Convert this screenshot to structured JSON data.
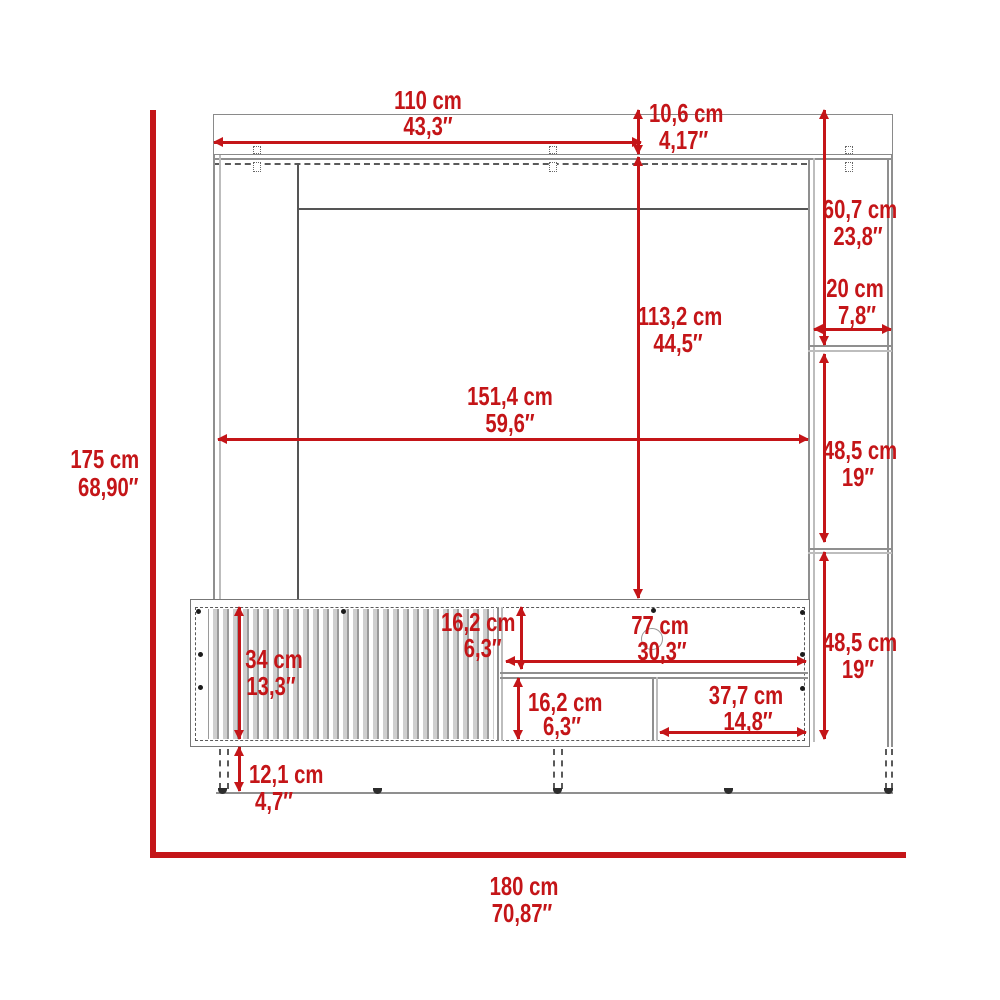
{
  "diagram_type": "furniture-dimension-drawing",
  "units": [
    "cm",
    "inches"
  ],
  "colors": {
    "dimension_red": "#c41518",
    "outline_gray": "#8a8a8a",
    "detail_dark_gray": "#555555",
    "background": "#ffffff"
  },
  "dims": {
    "overall_height": {
      "cm": "175 cm",
      "in": "68,90″"
    },
    "overall_width": {
      "cm": "180 cm",
      "in": "70,87″"
    },
    "top_width": {
      "cm": "110 cm",
      "in": "43,3″"
    },
    "top_panel_height": {
      "cm": "10,6 cm",
      "in": "4,17″"
    },
    "right_upper_height": {
      "cm": "60,7 cm",
      "in": "23,8″"
    },
    "side_depth": {
      "cm": "20 cm",
      "in": "7,8″"
    },
    "back_panel_height": {
      "cm": "113,2 cm",
      "in": "44,5″"
    },
    "interior_width": {
      "cm": "151,4 cm",
      "in": "59,6″"
    },
    "right_shelf_upper": {
      "cm": "48,5 cm",
      "in": "19″"
    },
    "right_shelf_lower": {
      "cm": "48,5 cm",
      "in": "19″"
    },
    "door_height": {
      "cm": "34 cm",
      "in": "13,3″"
    },
    "leg_clearance": {
      "cm": "12,1 cm",
      "in": "4,7″"
    },
    "upper_opening_height": {
      "cm": "16,2 cm",
      "in": "6,3″"
    },
    "center_opening_width": {
      "cm": "77 cm",
      "in": "30,3″"
    },
    "lower_opening_height": {
      "cm": "16,2 cm",
      "in": "6,3″"
    },
    "lower_compartment_width": {
      "cm": "37,7 cm",
      "in": "14,8″"
    }
  }
}
